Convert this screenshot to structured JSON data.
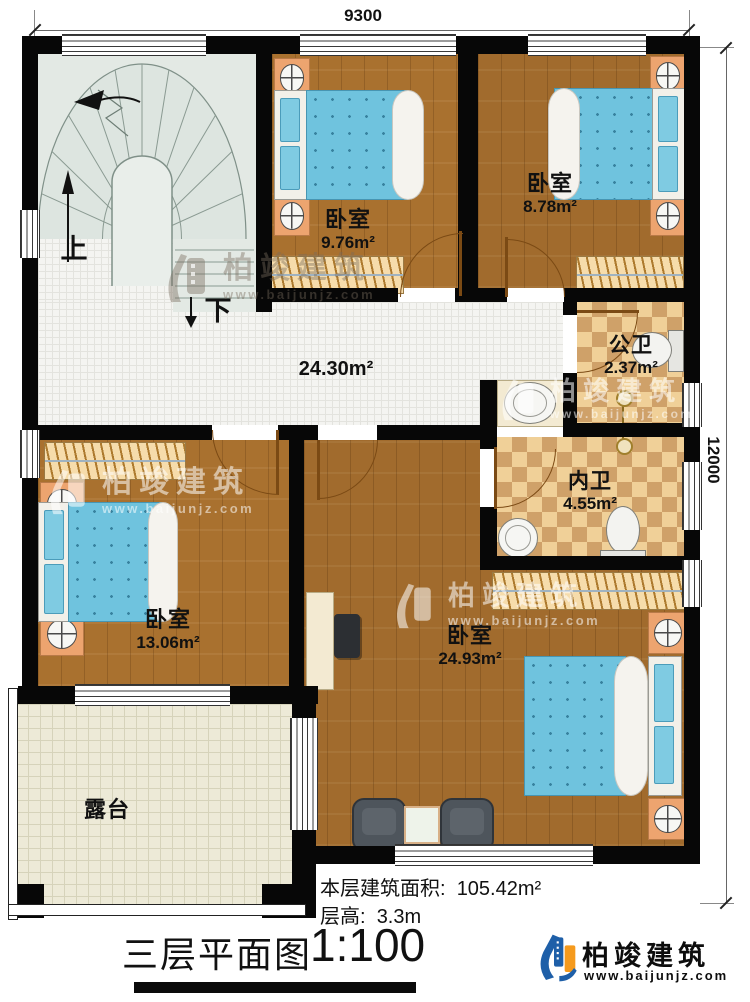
{
  "dimensions": {
    "top": "9300",
    "right": "12000"
  },
  "rooms": {
    "bedroom_top": {
      "label": "卧室",
      "area": "9.76m²"
    },
    "bedroom_topright": {
      "label": "卧室",
      "area": "8.78m²"
    },
    "hall": {
      "area": "24.30m²"
    },
    "public_bath": {
      "label": "公卫",
      "area": "2.37m²"
    },
    "inner_bath": {
      "label": "内卫",
      "area": "4.55m²"
    },
    "bedroom_left": {
      "label": "卧室",
      "area": "13.06m²"
    },
    "bedroom_master": {
      "label": "卧室",
      "area": "24.93m²"
    },
    "terrace": {
      "label": "露台"
    }
  },
  "stairs": {
    "up": "上",
    "down": "下"
  },
  "notes": {
    "area_label": "本层建筑面积:",
    "area_value": "105.42m²",
    "height_label": "层高:",
    "height_value": "3.3m"
  },
  "title": {
    "name": "三层平面图",
    "scale": "1:100"
  },
  "watermark": {
    "name": "柏竣建筑",
    "url": "www.baijunjz.com"
  },
  "brand": {
    "name": "柏竣建筑",
    "url": "www.baijunjz.com"
  },
  "colors": {
    "wood": "#a9712f",
    "hall_tile": "#f4f4f1",
    "bath_checker": "#f0d098",
    "terrace_tile": "#edead7",
    "mattress": "#6fc3de",
    "brand_blue": "#1e5fa8",
    "brand_orange": "#f59a1d"
  }
}
